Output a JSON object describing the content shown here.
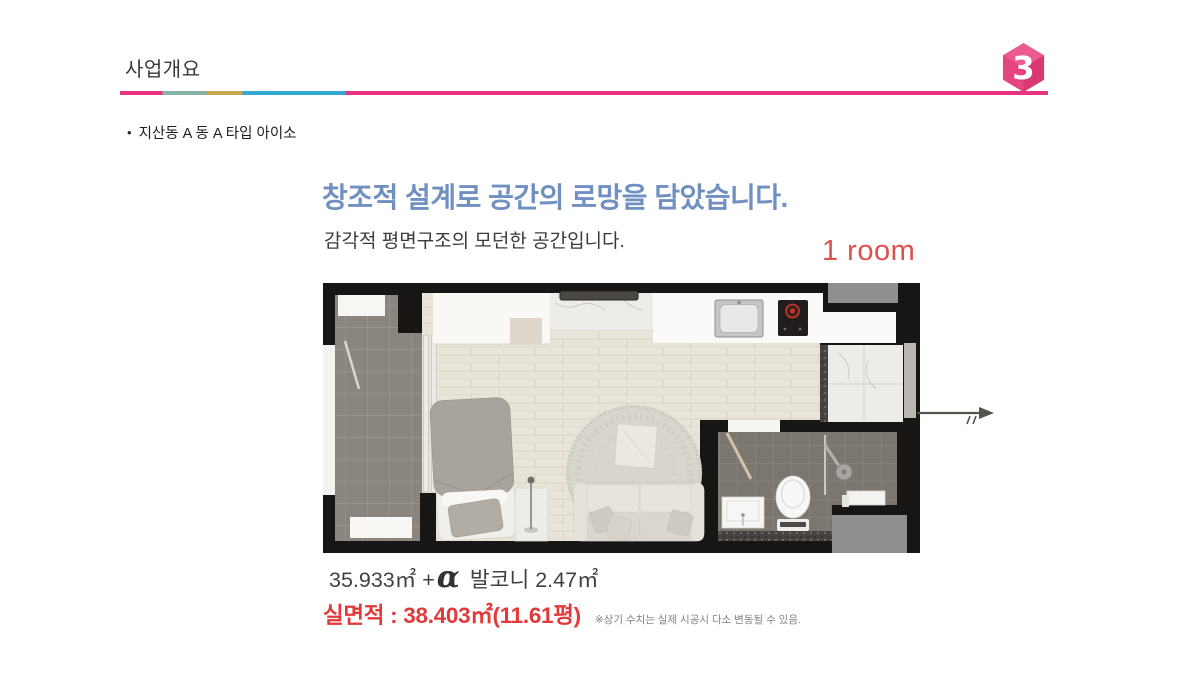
{
  "slide": {
    "header": {
      "title": "사업개요",
      "rule_colors": [
        "#e73380",
        "#85b3a6",
        "#c7a64e",
        "#33aad4",
        "#e73380"
      ],
      "logo_color": "#e5457e",
      "logo_glyph": "3"
    },
    "bullet_line": {
      "marker": "•",
      "text": "지산동 A 동 A 타입 아이소"
    },
    "body": {
      "heading": "창조적 설계로 공간의 로망을 담았습니다.",
      "heading_color": "#7090c2",
      "subheading": "감각적 평면구조의 모던한 공간입니다.",
      "room_badge": "1 room",
      "room_badge_color": "#dd514d"
    },
    "area_info": {
      "gross_prefix": "35.933㎡ + ",
      "alpha_symbol": "α",
      "gross_suffix": "발코니 2.47㎡",
      "net_text": "실면적 : 38.403㎡(11.61평)",
      "net_color": "#e2393b",
      "disclaimer": "※상기 수치는 실제 시공시 다소 변동될 수 있음."
    }
  }
}
